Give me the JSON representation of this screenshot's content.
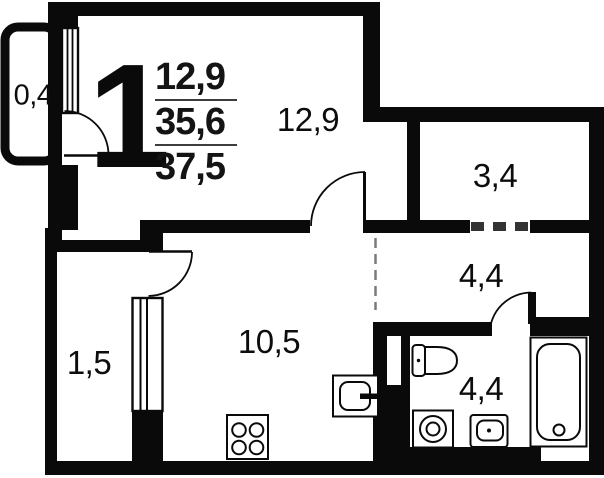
{
  "legend": {
    "rooms_count": "1",
    "line1": "12,9",
    "line2": "35,6",
    "line3": "37,5"
  },
  "rooms": {
    "balcony": "0,4",
    "living": "12,9",
    "storage": "3,4",
    "hallway": "4,4",
    "bathroom": "4,4",
    "kitchen": "10,5",
    "closet": "1,5"
  },
  "colors": {
    "wall": "#0a0a0a",
    "background": "#ffffff",
    "dashed_line": "#7a7a7a",
    "opening_dash": "#333333",
    "legend_divider": "#3d3d3d"
  }
}
